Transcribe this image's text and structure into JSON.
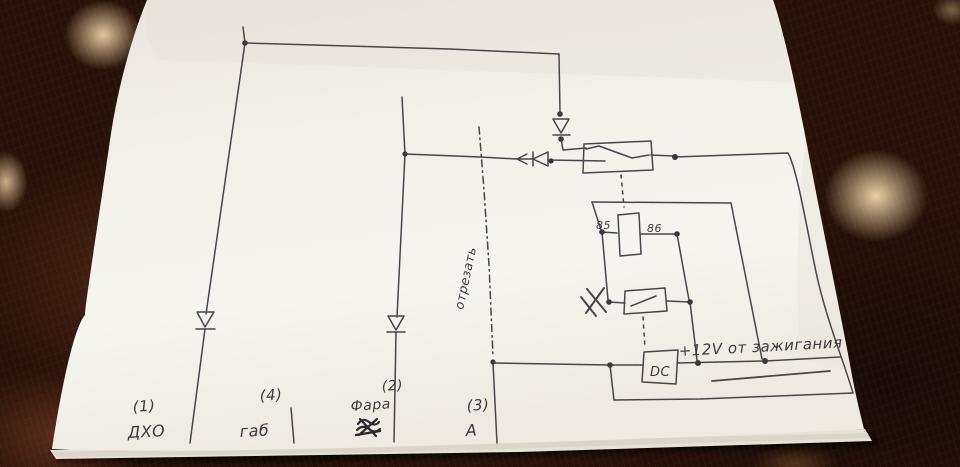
{
  "scene": {
    "description": "Hand-drawn relay wiring schematic on white paper photographed on a dark brown spotted blanket"
  },
  "colors": {
    "ink": "#4a424b",
    "paper": "#f4f1ea",
    "fabric": "#271209",
    "spot": "#eed7a8"
  },
  "schematic": {
    "terminals": [
      {
        "num": "(1)",
        "label": "ДХО"
      },
      {
        "num": "(4)",
        "label": "габ"
      },
      {
        "num": "(2)",
        "label": "Фара"
      },
      {
        "num": "(3)",
        "label": "А"
      }
    ],
    "relay": {
      "pin_left": "85",
      "pin_right": "86"
    },
    "module_label": "DC",
    "ignition_label": "+12V от зажигания",
    "cut_label": "отрезать"
  }
}
